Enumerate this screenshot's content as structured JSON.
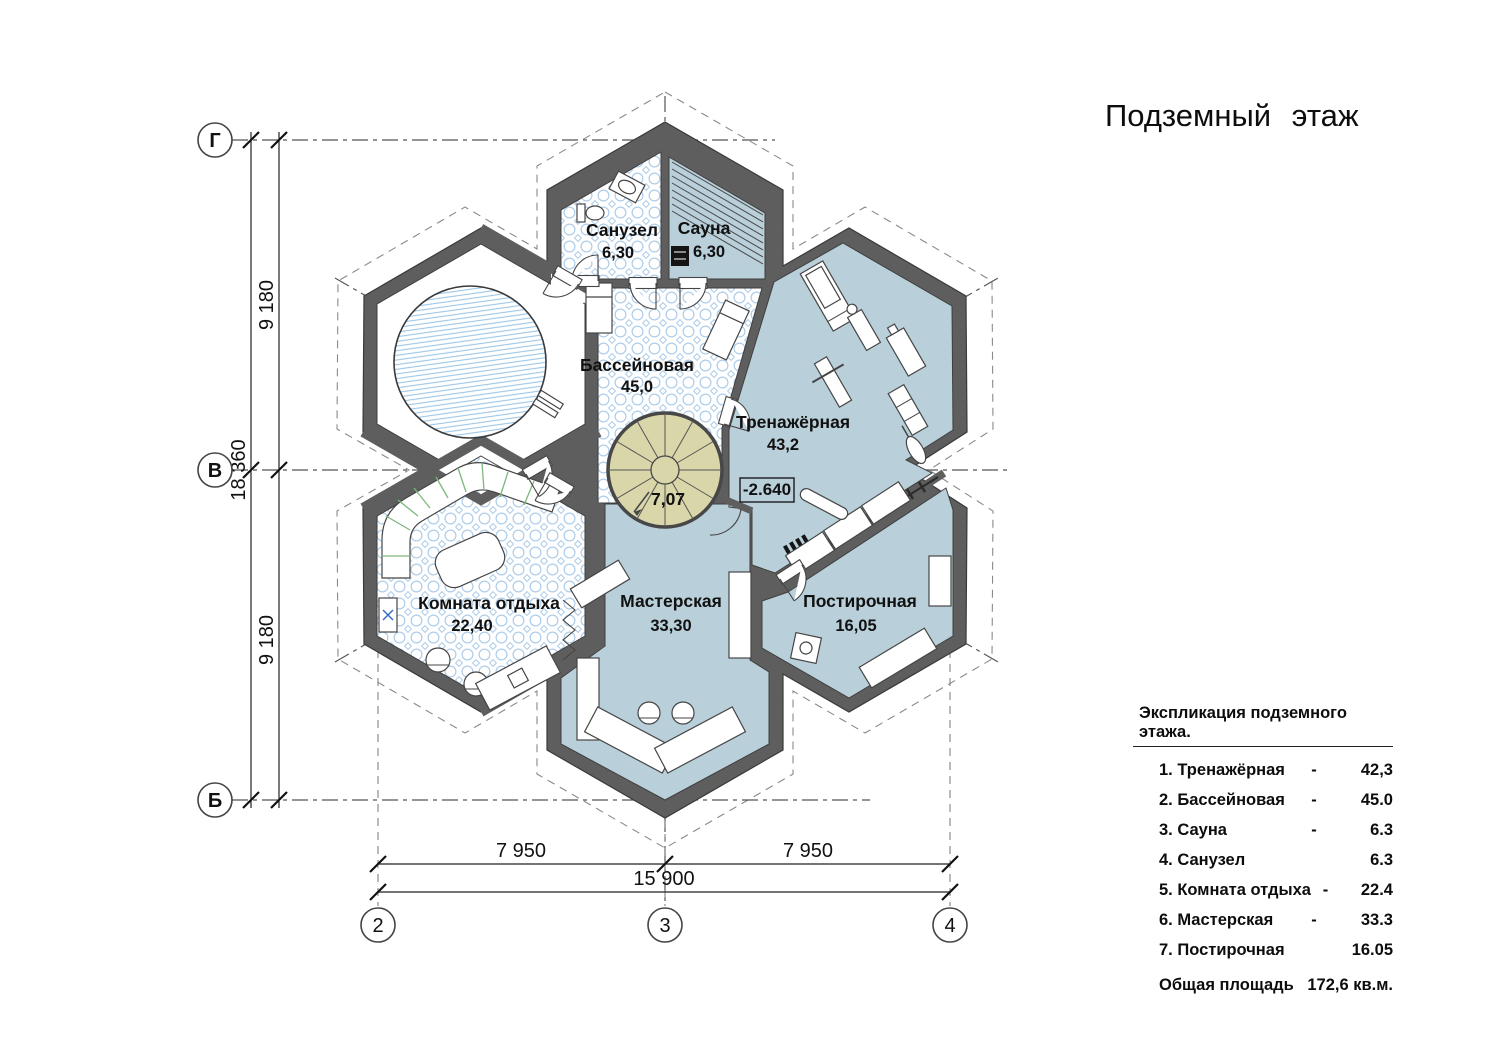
{
  "title": "Подземный этаж",
  "colors": {
    "wall": "#5e5e5e",
    "floor_blue": "#b9cfd9",
    "tile_line": "#aecdea",
    "pool_line": "#9cc6e6",
    "stair_fill": "#d9d6aa",
    "sofa_accent": "#7cb87c",
    "cross_accent": "#3a6bc4",
    "ink": "#111111",
    "paper": "#ffffff"
  },
  "plan": {
    "rooms": [
      {
        "name": "Санузел",
        "area": "6,30"
      },
      {
        "name": "Сауна",
        "area": "6,30"
      },
      {
        "name": "Бассейновая",
        "area": "45,0"
      },
      {
        "name": "Тренажёрная",
        "area": "43,2"
      },
      {
        "name": "Комната отдыха",
        "area": "22,40"
      },
      {
        "name": "Мастерская",
        "area": "33,30"
      },
      {
        "name": "Постирочная",
        "area": "16,05"
      }
    ],
    "stair_area": "7,07",
    "elevation": "-2.640"
  },
  "axes": {
    "horizontal": [
      "Г",
      "В",
      "Б"
    ],
    "vertical": [
      "2",
      "3",
      "4"
    ]
  },
  "dimensions": {
    "left_segments": [
      "9 180",
      "9 180"
    ],
    "left_total": "18 360",
    "bottom_segments": [
      "7 950",
      "7 950"
    ],
    "bottom_total": "15 900"
  },
  "legend": {
    "header": "Экспликация подземного этажа.",
    "rows": [
      {
        "num": "1.",
        "name": "Тренажёрная",
        "dash": "-",
        "value": "42,3"
      },
      {
        "num": "2.",
        "name": "Бассейновая",
        "dash": "-",
        "value": "45.0"
      },
      {
        "num": "3.",
        "name": "Сауна",
        "dash": "-",
        "value": "6.3"
      },
      {
        "num": "4.",
        "name": "Санузел",
        "dash": "",
        "value": "6.3"
      },
      {
        "num": "5.",
        "name": "Комната отдыха",
        "dash": "-",
        "value": "22.4"
      },
      {
        "num": "6.",
        "name": "Мастерская",
        "dash": "-",
        "value": "33.3"
      },
      {
        "num": "7.",
        "name": "Постирочная",
        "dash": "",
        "value": "16.05"
      }
    ],
    "total": {
      "label": "Общая площадь",
      "value": "172,6 кв.м."
    }
  }
}
